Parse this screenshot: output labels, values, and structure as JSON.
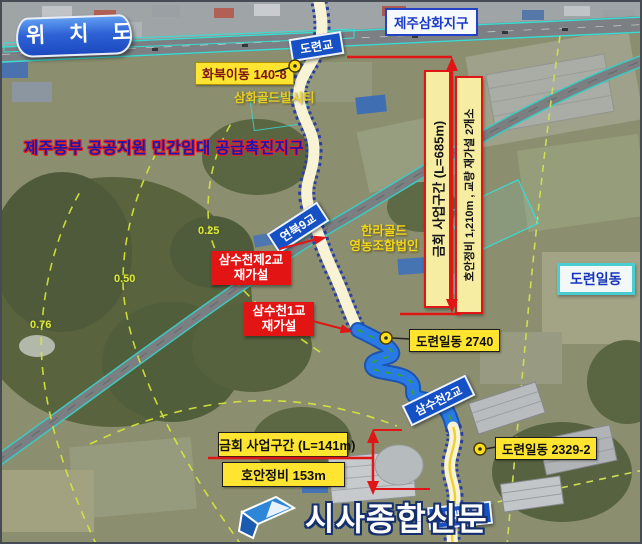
{
  "header": {
    "map_title": "위 치 도"
  },
  "colors": {
    "annotation_red": "#e01515",
    "bridge_label_blue": "#1550c4",
    "lot_label_yellow": "#ffe530",
    "section_box_yellow": "#f7eda2",
    "river_blue": "#2a7ae6",
    "river_path_cream": "#f8f3d4",
    "area_border_cyan": "#49ccd2",
    "project_title_blue": "#1717b2"
  },
  "labels": {
    "samhwa_district": "제주삼화지구",
    "doryeon_bridge": "도련교",
    "hwabuk_lot": "화북이동 140-8",
    "samhwa_gold_city": "삼화골드빌시티",
    "project_title": "제주동부 공공지원 민간임대 공급촉진지구",
    "section_main": "금회 사업구간 (L=685m)",
    "section_main_detail": "호안정비 1,210m , 교량 재가설 2개소",
    "yeonbuk_bridge": "연북9교",
    "halla_gold_line1": "한라골드",
    "halla_gold_line2": "영농조합법인",
    "samsu2_rebuild_line1": "삼수천제2교",
    "samsu2_rebuild_line2": "재가설",
    "samsu1_rebuild_line1": "삼수천1교",
    "samsu1_rebuild_line2": "재가설",
    "doryeonildong_area": "도련일동",
    "doryeon_lot_2740": "도련일동 2740",
    "samsu2_bridge": "삼수천2교",
    "section_small": "금회 사업구간 (L=141m)",
    "section_small_detail": "호안정비 153m",
    "doryeon_lot_2329": "도련일동 2329-2",
    "alsaegil_bridge": "알새질교",
    "contour_025": "0.25",
    "contour_050": "0.50",
    "contour_076": "0.76"
  },
  "watermark": {
    "name": "시사종합신문"
  }
}
